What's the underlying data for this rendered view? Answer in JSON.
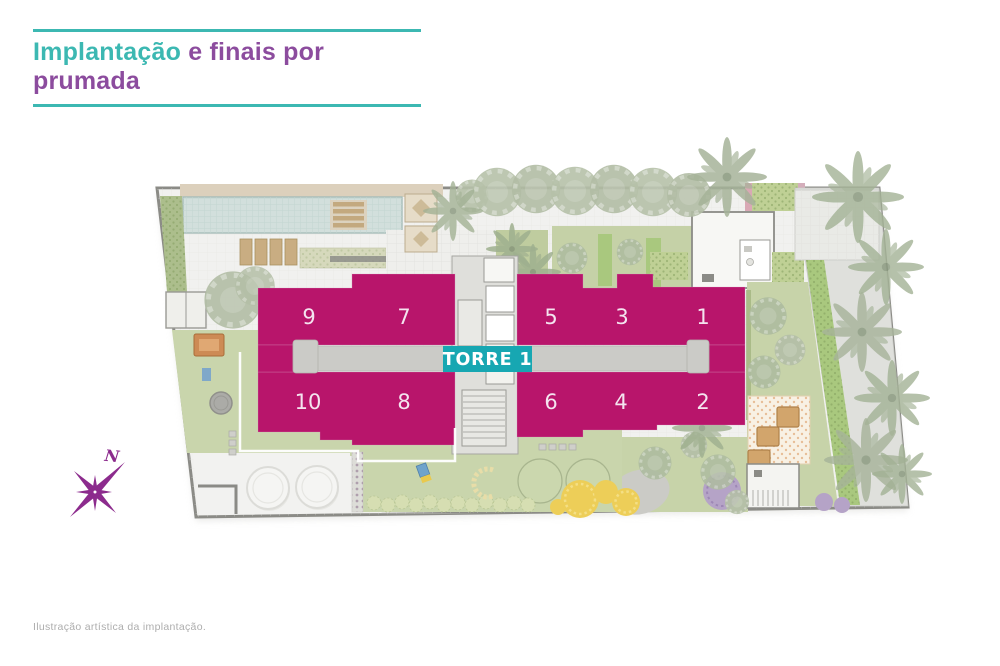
{
  "header": {
    "title_highlight": "Implantação",
    "title_rest": "e finais por prumada",
    "colors": {
      "highlight": "#3CB8B2",
      "rest": "#8C4C9E",
      "rule": "#3CB8B2"
    }
  },
  "plan": {
    "tower": {
      "label": "TORRE 1",
      "bg_color": "#17A7B2",
      "text_color": "#FFFFFF"
    },
    "units_top": [
      {
        "label": "9"
      },
      {
        "label": "7"
      },
      {
        "label": "5"
      },
      {
        "label": "3"
      },
      {
        "label": "1"
      }
    ],
    "units_bottom": [
      {
        "label": "10"
      },
      {
        "label": "8"
      },
      {
        "label": "6"
      },
      {
        "label": "4"
      },
      {
        "label": "2"
      }
    ],
    "colors": {
      "unit_fill": "#B8156B",
      "corridor": "#CBCBC7",
      "lawn": "#C9D5AC",
      "bright_green": "#A9C87E",
      "tree": "#B6C1A9",
      "palm": "#A3B295",
      "pool": "#D2DFDC",
      "deck": "#DCD0BC",
      "paving": "#F1F1EF",
      "road": "#DFE0DC",
      "yellow_shrub": "#EDCE58",
      "purple_tree": "#B5A3C7",
      "boundary": "#8B8B86"
    }
  },
  "compass": {
    "label": "N",
    "color": "#8C2B8D"
  },
  "footer": {
    "caption": "Ilustração artística da implantação."
  }
}
